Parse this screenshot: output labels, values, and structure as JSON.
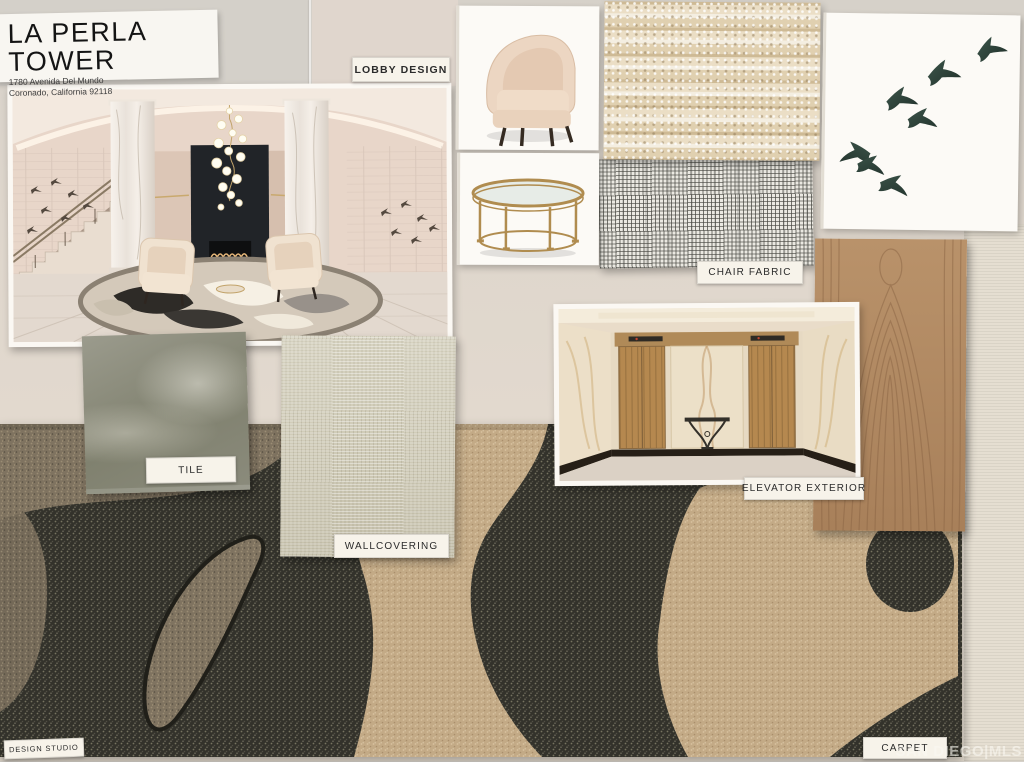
{
  "board": {
    "title_card": {
      "title": "LA PERLA TOWER",
      "address_line1": "1780 Avenida Del Mundo",
      "address_line2": "Coronado, California 92118"
    },
    "labels": {
      "lobby_design": "LOBBY DESIGN",
      "chair_fabric": "CHAIR FABRIC",
      "tile": "TILE",
      "wallcovering": "WALLCOVERING",
      "elevator_exterior": "ELEVATOR EXTERIOR",
      "carpet": "CARPET",
      "design_studio": "DESIGN STUDIO"
    },
    "watermark": "SAN DIEGO|MLS",
    "samples": [
      {
        "name": "lobby-rendering"
      },
      {
        "name": "armchair-photo"
      },
      {
        "name": "coffee-table-photo"
      },
      {
        "name": "boucle-fabric-swatch"
      },
      {
        "name": "grid-weave-fabric-swatch"
      },
      {
        "name": "birds-artwork"
      },
      {
        "name": "tile-sample"
      },
      {
        "name": "wallcovering-sample"
      },
      {
        "name": "elevator-rendering"
      },
      {
        "name": "wood-veneer-sample"
      },
      {
        "name": "carpet-sample"
      }
    ],
    "colors": {
      "board_background": "#dcd4c9",
      "card_white": "#f8f5ef",
      "carpet_charcoal": "#34332b",
      "carpet_beige": "#c3aa86",
      "carpet_taupe": "#7f7360",
      "wood_oak": "#b28a5e",
      "tile_gray": "#87877a",
      "wallcovering_sage": "#cfcab6",
      "brass_gold": "#b08c4f",
      "bird_teal": "#2c423a",
      "fireplace_black": "#212428"
    }
  }
}
